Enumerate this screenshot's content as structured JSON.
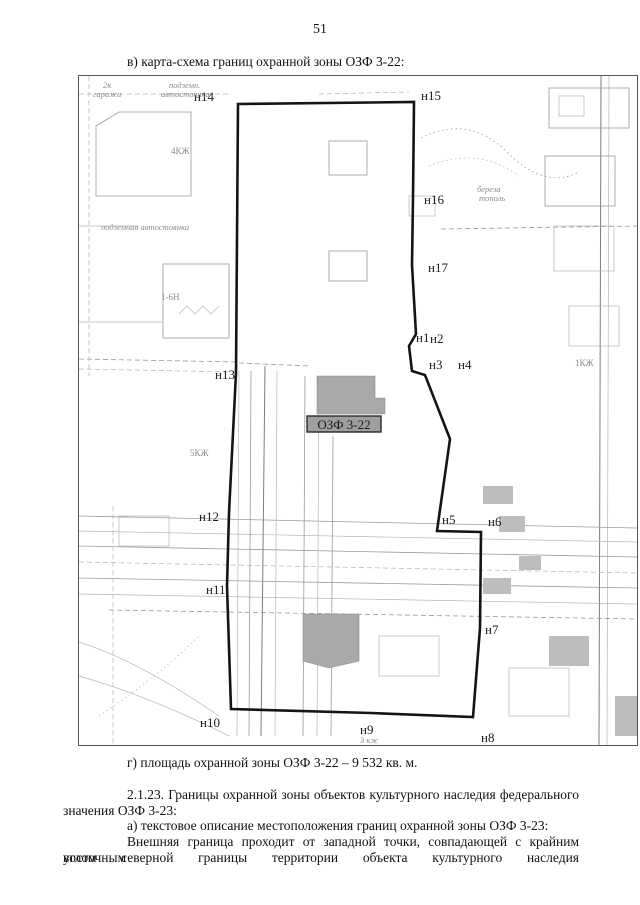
{
  "page": {
    "number": "51",
    "caption_map": "в) карта-схема границ охранной зоны ОЗФ 3-22:",
    "caption_area": "г) площадь охранной зоны ОЗФ 3-22 – 9 532 кв. м.",
    "para_2123_line1": "2.1.23. Границы охранной зоны объектов культурного наследия федерального",
    "para_2123_line2": "значения ОЗФ 3-23:",
    "caption_a": "а) текстовое описание местоположения границ охранной зоны ОЗФ 3-23:",
    "para_outer_line1": "Внешняя граница проходит от западной точки, совпадающей с крайним восточным",
    "para_outer_line2": "углом северной границы территории объекта культурного наследия"
  },
  "map": {
    "zone_label": "ОЗФ 3-22",
    "points": [
      {
        "label": "н1"
      },
      {
        "label": "н2"
      },
      {
        "label": "н3"
      },
      {
        "label": "н4"
      },
      {
        "label": "н5"
      },
      {
        "label": "н6"
      },
      {
        "label": "н7"
      },
      {
        "label": "н8"
      },
      {
        "label": "н9"
      },
      {
        "label": "н10"
      },
      {
        "label": "н11"
      },
      {
        "label": "н12"
      },
      {
        "label": "н13"
      },
      {
        "label": "н14"
      },
      {
        "label": "н15"
      },
      {
        "label": "н16"
      },
      {
        "label": "н17"
      }
    ],
    "area_labels": {
      "garage_line1": "2к",
      "garage_line2": "гаражи",
      "underground1_line1": "подземн.",
      "underground1_line2": "автостоянка",
      "underground2": "подземная автостоянка",
      "bld_4kzh": "4КЖ",
      "bld_16n": "1-6Н",
      "trees_line1": "береза",
      "trees_line2": "тополь",
      "bld_1kzh": "1КЖ",
      "bld_5kzh": "5КЖ",
      "bld_3kzh": "3 кж"
    },
    "colors": {
      "boundary": "#141414",
      "detail": "#9a9a9a",
      "building_fill": "#a9a9a9"
    }
  }
}
